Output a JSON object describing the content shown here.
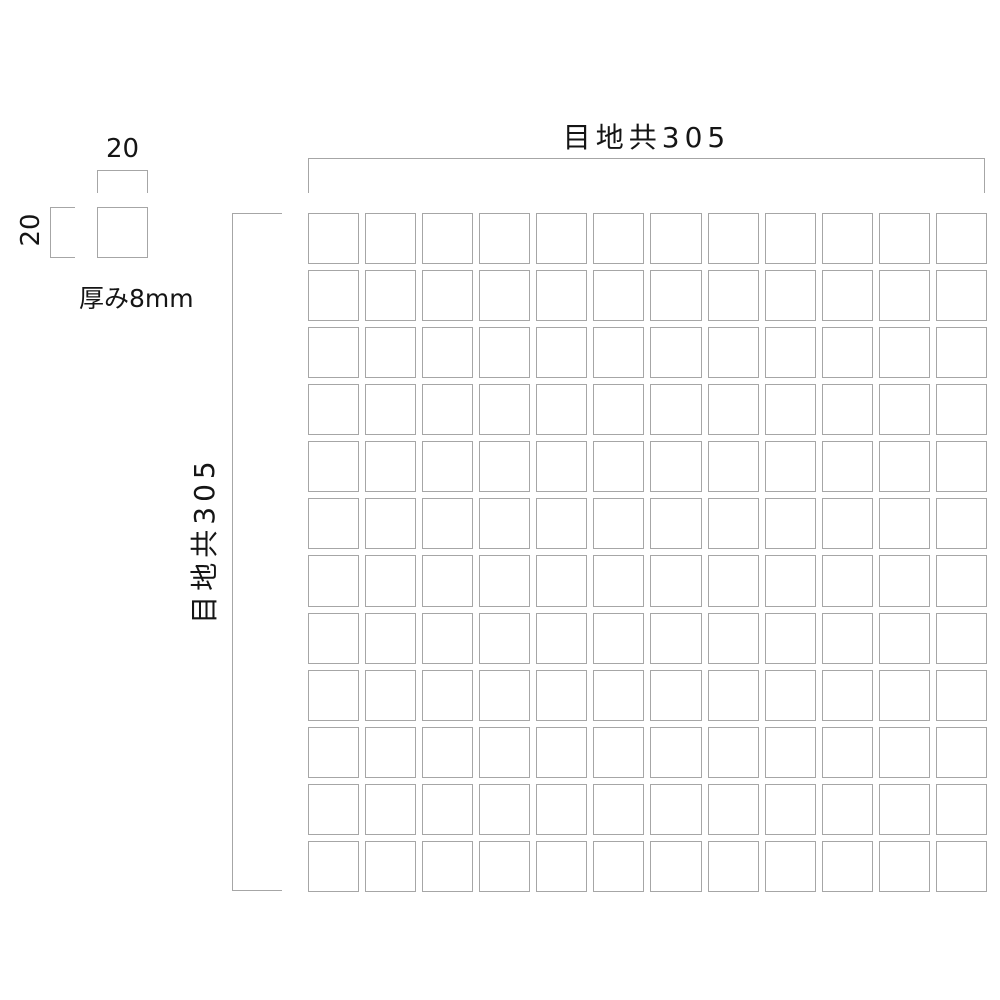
{
  "diagram": {
    "type": "mosaic-tile-sheet-dimension-drawing",
    "sheet": {
      "dim_horizontal_label": "目地共305",
      "dim_vertical_label": "目地共305",
      "grid_rows": 12,
      "grid_cols": 12
    },
    "tile_detail": {
      "width_label": "20",
      "height_label": "20",
      "thickness_label": "厚み8mm"
    },
    "colors": {
      "line": "#a6a6a6",
      "text": "#151515",
      "background": "#ffffff"
    }
  }
}
